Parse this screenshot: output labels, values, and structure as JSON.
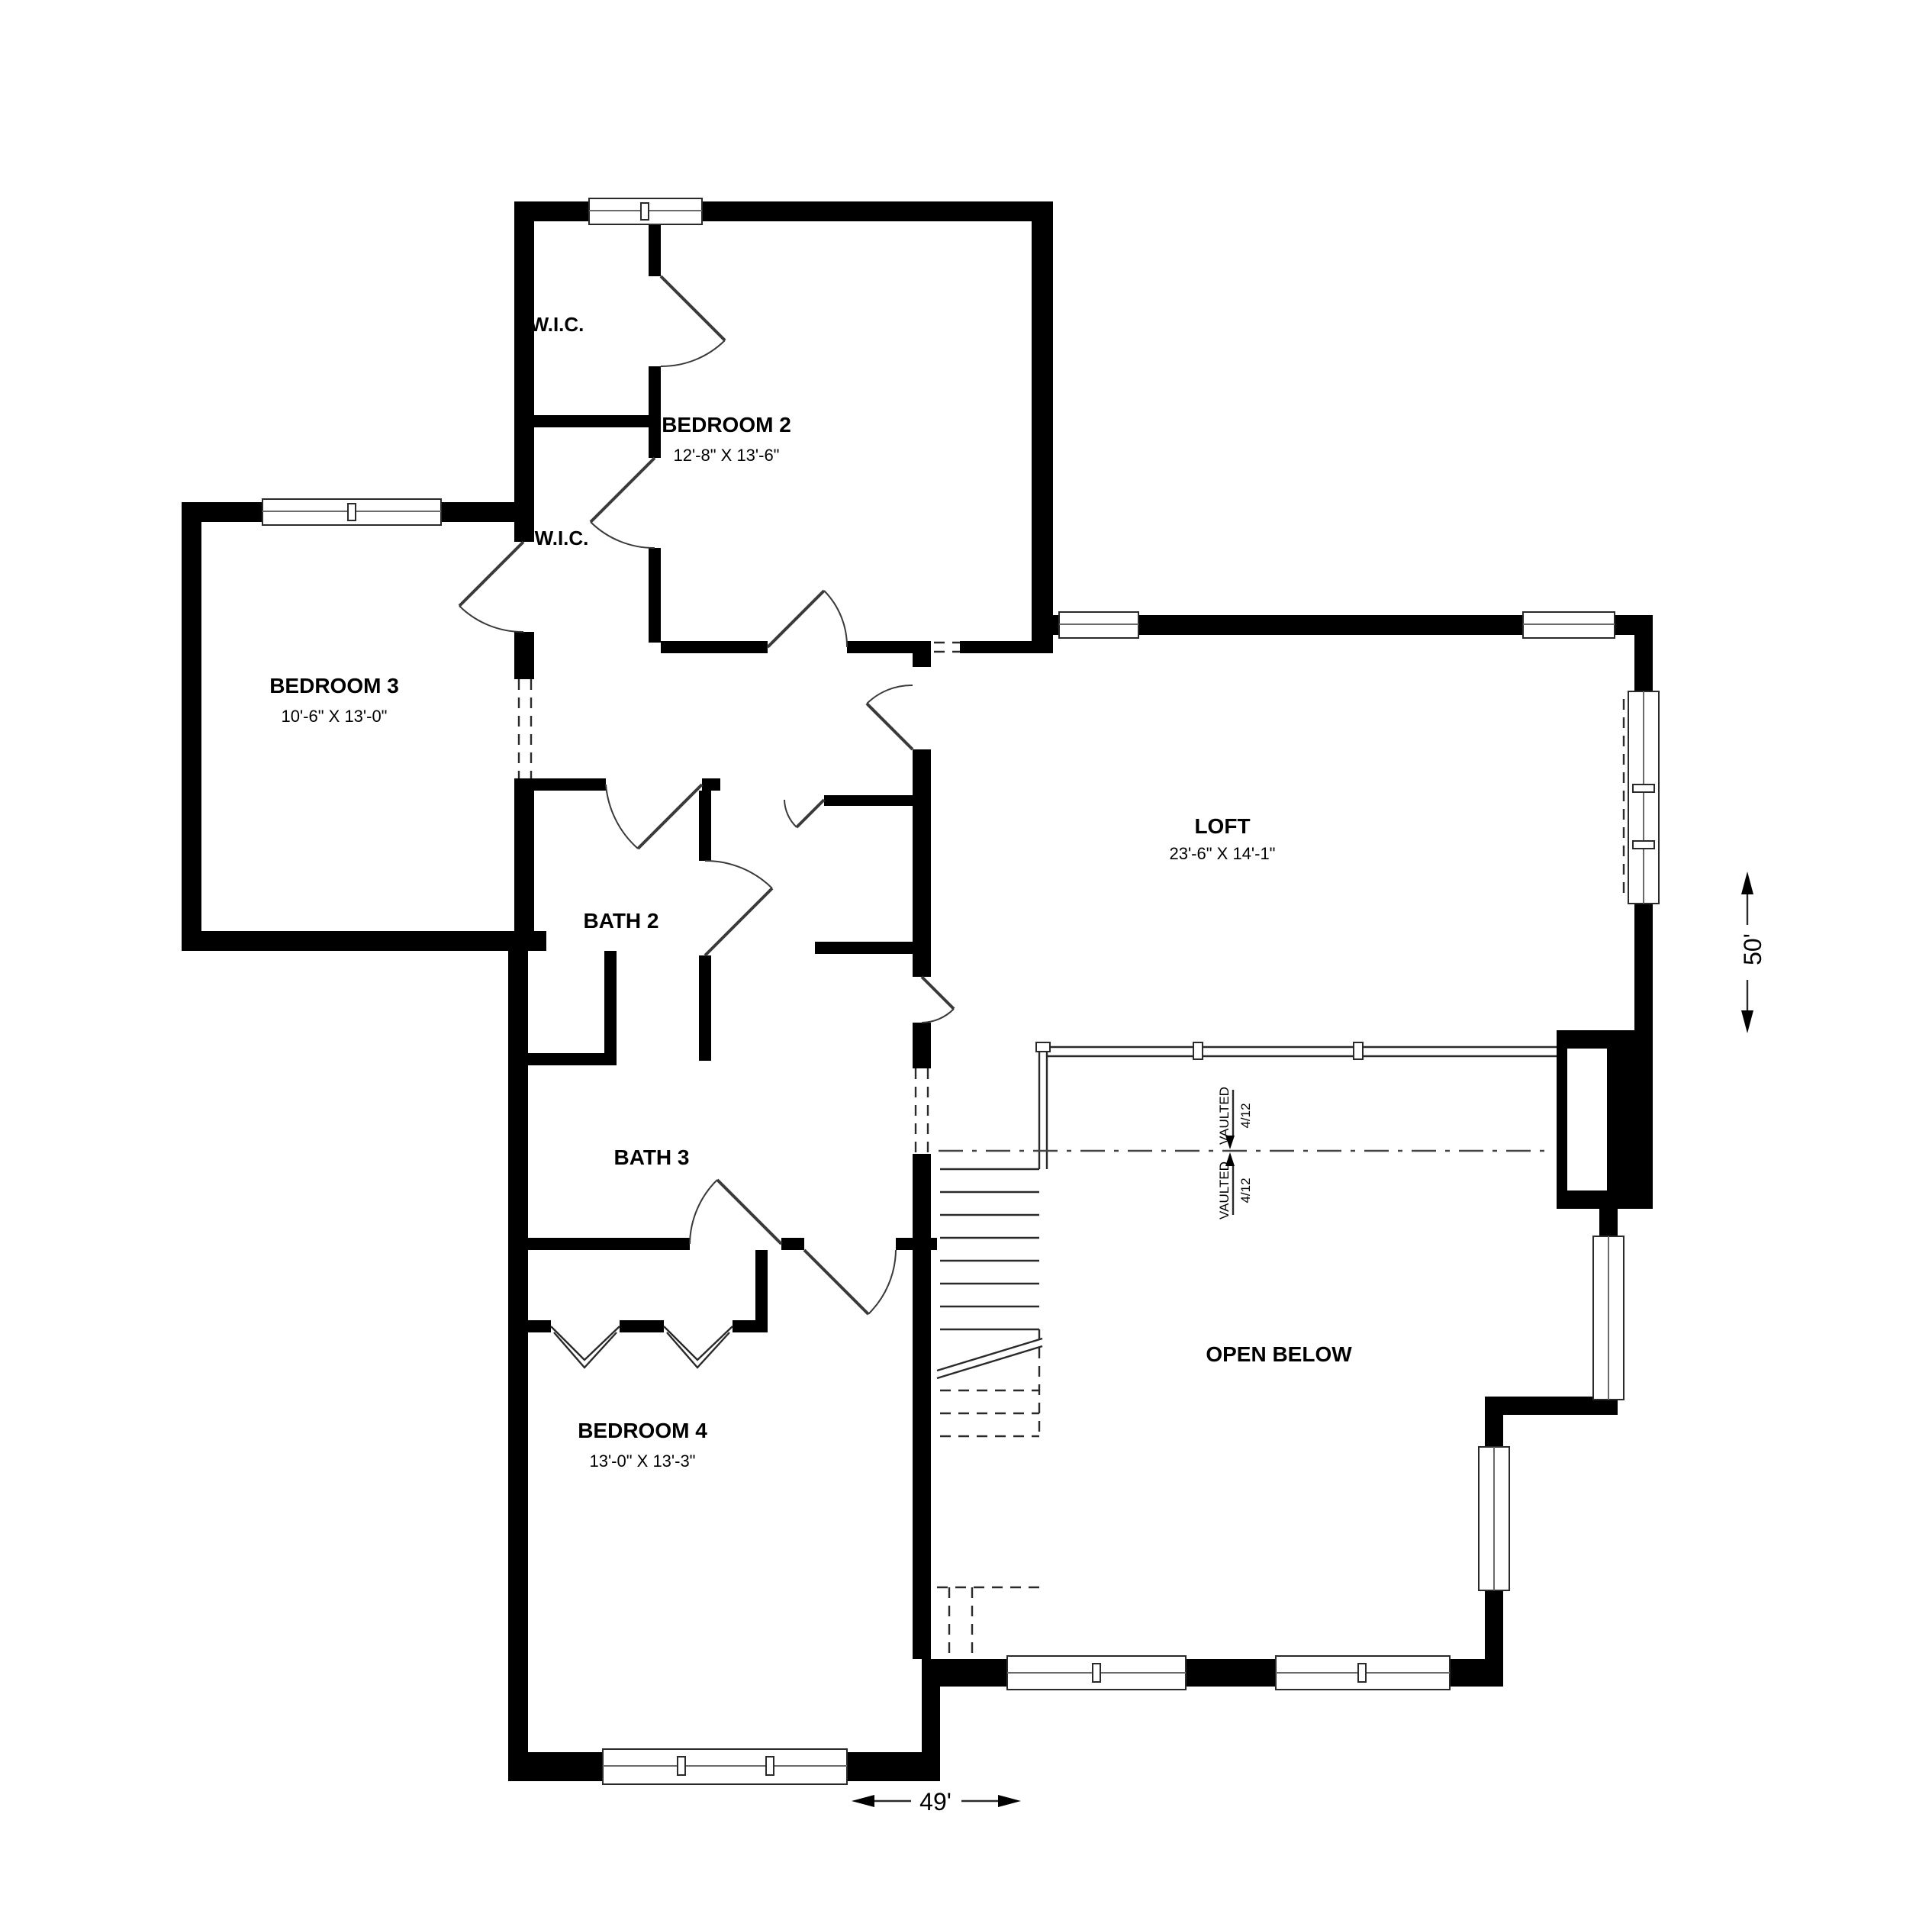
{
  "plan": {
    "rooms": {
      "wic_upper": {
        "label": "W.I.C."
      },
      "wic_lower": {
        "label": "W.I.C."
      },
      "bedroom2": {
        "label": "BEDROOM 2",
        "dims": "12'-8\" X 13'-6\""
      },
      "bedroom3": {
        "label": "BEDROOM 3",
        "dims": "10'-6\" X 13'-0\""
      },
      "bath2": {
        "label": "BATH 2"
      },
      "bath3": {
        "label": "BATH 3"
      },
      "bedroom4": {
        "label": "BEDROOM 4",
        "dims": "13'-0\" X 13'-3\""
      },
      "loft": {
        "label": "LOFT",
        "dims": "23'-6\" X 14'-1\""
      },
      "open_below": {
        "label": "OPEN BELOW"
      }
    },
    "vault": {
      "upper_label": "VAULTED",
      "upper_pitch": "4/12",
      "lower_label": "VAULTED",
      "lower_pitch": "4/12"
    },
    "dimensions": {
      "horizontal": "49'",
      "vertical": "50'"
    },
    "colors": {
      "wall": "#000000",
      "background": "#ffffff",
      "line": "#2a2a2a"
    }
  }
}
